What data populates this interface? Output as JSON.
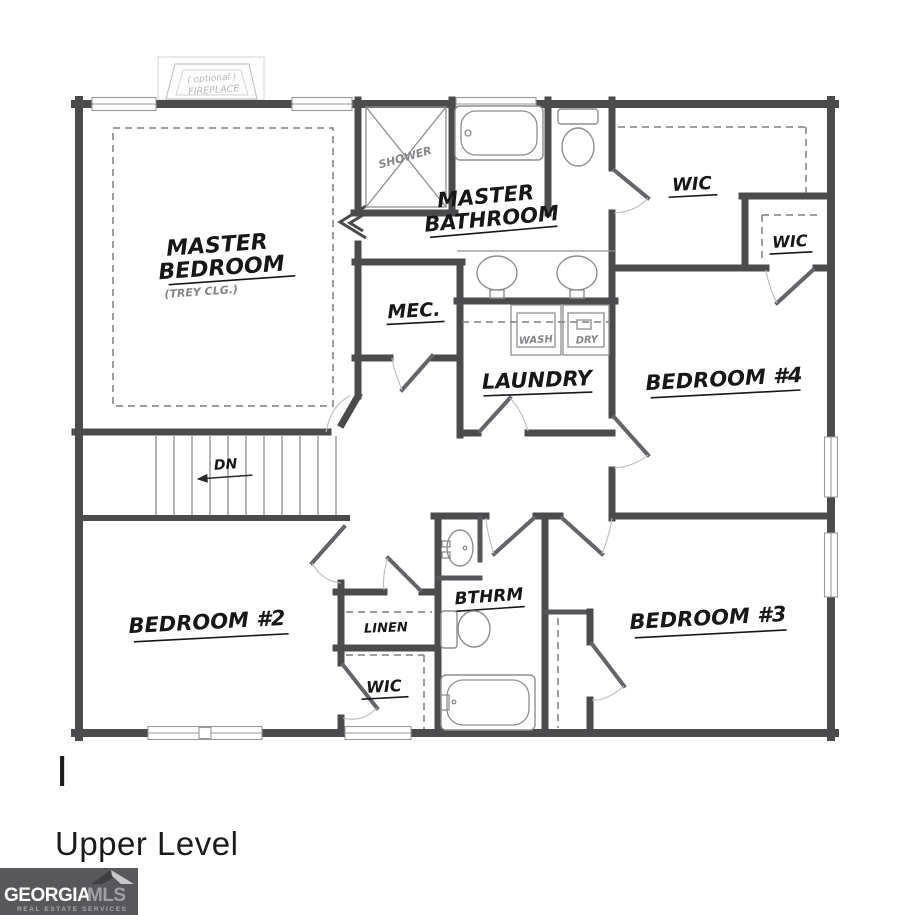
{
  "floor_plan": {
    "fireplace": {
      "line1": "( optional )",
      "line2": "FIREPLACE"
    },
    "master_bedroom": {
      "line1": "MASTER",
      "line2": "BEDROOM",
      "ceiling_note": "(TREY CLG.)"
    },
    "master_bathroom": {
      "line1": "MASTER",
      "line2": "BATHROOM",
      "shower": "SHOWER"
    },
    "wic_master": "WIC",
    "wic_right": "WIC",
    "wic_bedroom2": "WIC",
    "mec": "MEC.",
    "laundry": {
      "name": "LAUNDRY",
      "washer": "WASH",
      "dryer": "DRY"
    },
    "bedroom_4": "BEDROOM #4",
    "bedroom_2": "BEDROOM #2",
    "bedroom_3": "BEDROOM #3",
    "bathroom": "BTHRM",
    "linen": "LINEN",
    "stairs": {
      "direction": "DN"
    }
  },
  "caption": {
    "mark": "I",
    "level": "Upper Level"
  },
  "logo": {
    "brand": "GEORGIA",
    "brand_suffix": "MLS",
    "tagline": "REAL ESTATE SERVICES"
  },
  "colors": {
    "wall": "#4b4b4d",
    "fixture_line": "#8e8e90",
    "label": "#17171a",
    "logo_bg": "#58585a",
    "page_bg": "#ffffff"
  }
}
